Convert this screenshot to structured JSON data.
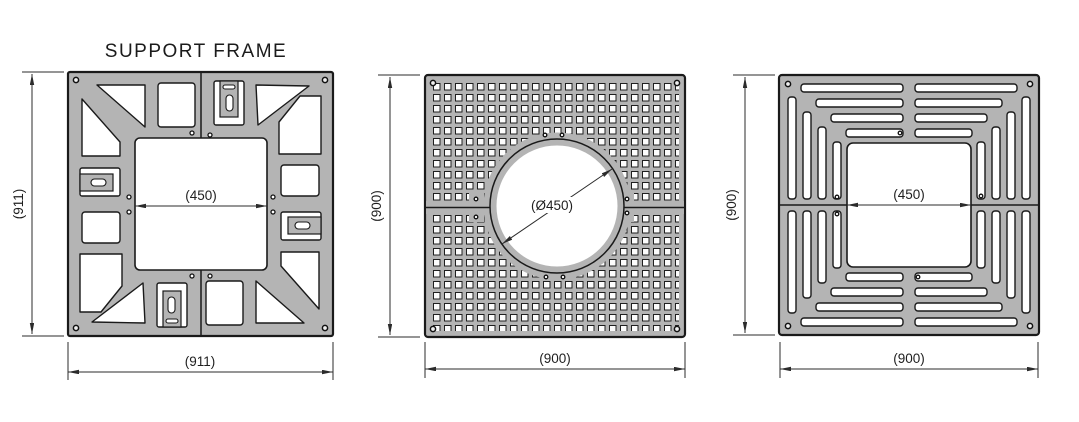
{
  "title": "SUPPORT FRAME",
  "views": [
    {
      "name": "support-frame",
      "height_dim": "(911)",
      "width_dim": "(911)",
      "opening_dim": "(450)"
    },
    {
      "name": "perforated-grate",
      "height_dim": "(900)",
      "width_dim": "(900)",
      "opening_dim": "(Ø450)"
    },
    {
      "name": "slotted-grate",
      "height_dim": "(900)",
      "width_dim": "(900)",
      "opening_dim": "(450)"
    }
  ],
  "colors": {
    "plate": "#b4b4b4",
    "outline": "#1a1a1a",
    "dimension_lines": "#2b2b2b",
    "text": "#1f1f1f",
    "background": "#ffffff"
  }
}
